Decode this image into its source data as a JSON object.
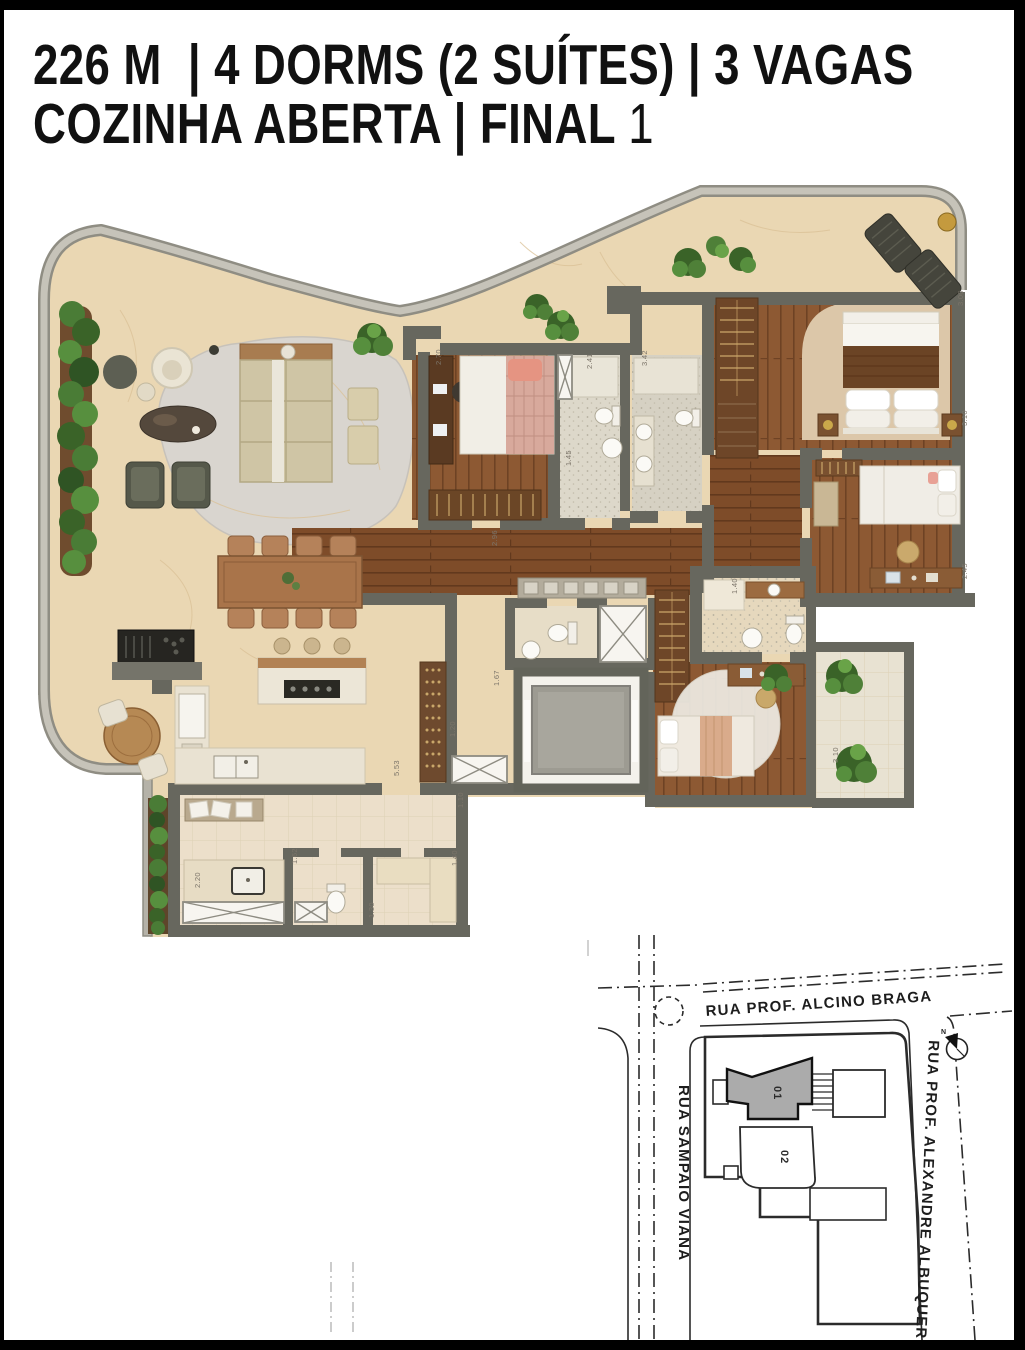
{
  "header": {
    "line1": "226 M  | 4 DORMS (2 SUÍTES) | 3 VAGAS",
    "line2_main": "COZINHA ABERTA | FINAL ",
    "line2_number": "1"
  },
  "floor_plan": {
    "dimension_labels": [
      {
        "t": "2.70",
        "x": 441,
        "y": 365,
        "r": -90
      },
      {
        "t": "2.41",
        "x": 592,
        "y": 369,
        "r": -90
      },
      {
        "t": "3.42",
        "x": 647,
        "y": 366,
        "r": -90
      },
      {
        "t": "1.45",
        "x": 571,
        "y": 466,
        "r": -90
      },
      {
        "t": "2.96",
        "x": 497,
        "y": 546,
        "r": -90
      },
      {
        "t": "3.00",
        "x": 963,
        "y": 306,
        "r": -90
      },
      {
        "t": "3.10",
        "x": 967,
        "y": 426,
        "r": -90
      },
      {
        "t": "2.45",
        "x": 967,
        "y": 579,
        "r": -90
      },
      {
        "t": "1.40",
        "x": 737,
        "y": 594,
        "r": -90
      },
      {
        "t": "1.67",
        "x": 499,
        "y": 686,
        "r": -90
      },
      {
        "t": "1.20",
        "x": 455,
        "y": 737,
        "r": -90
      },
      {
        "t": "5.53",
        "x": 399,
        "y": 776,
        "r": -90
      },
      {
        "t": "3.10",
        "x": 838,
        "y": 763,
        "r": -90
      },
      {
        "t": "1.10",
        "x": 463,
        "y": 808,
        "r": -90
      },
      {
        "t": "2.20",
        "x": 200,
        "y": 888,
        "r": -90
      },
      {
        "t": "1.62",
        "x": 297,
        "y": 864,
        "r": -90
      },
      {
        "t": "1.30",
        "x": 374,
        "y": 918,
        "r": -90
      },
      {
        "t": "1.40",
        "x": 457,
        "y": 866,
        "r": -90
      }
    ]
  },
  "site_map": {
    "street_top": "RUA PROF. ALCINO BRAGA",
    "street_left": "RUA SAMPAIO VIANA",
    "street_right": "RUA PROF. ALEXANDRE ALBUQUERQUE",
    "building_01_label": "01",
    "building_02_label": "02",
    "compass_north_label": "N"
  },
  "colors": {
    "frame": "#000000",
    "wall": "#67675e",
    "terrace_floor": "#ead7b3",
    "wood_floor": "#8a5530",
    "hedge_green": "#4a7c36",
    "map_building_highlight": "#ababab"
  }
}
